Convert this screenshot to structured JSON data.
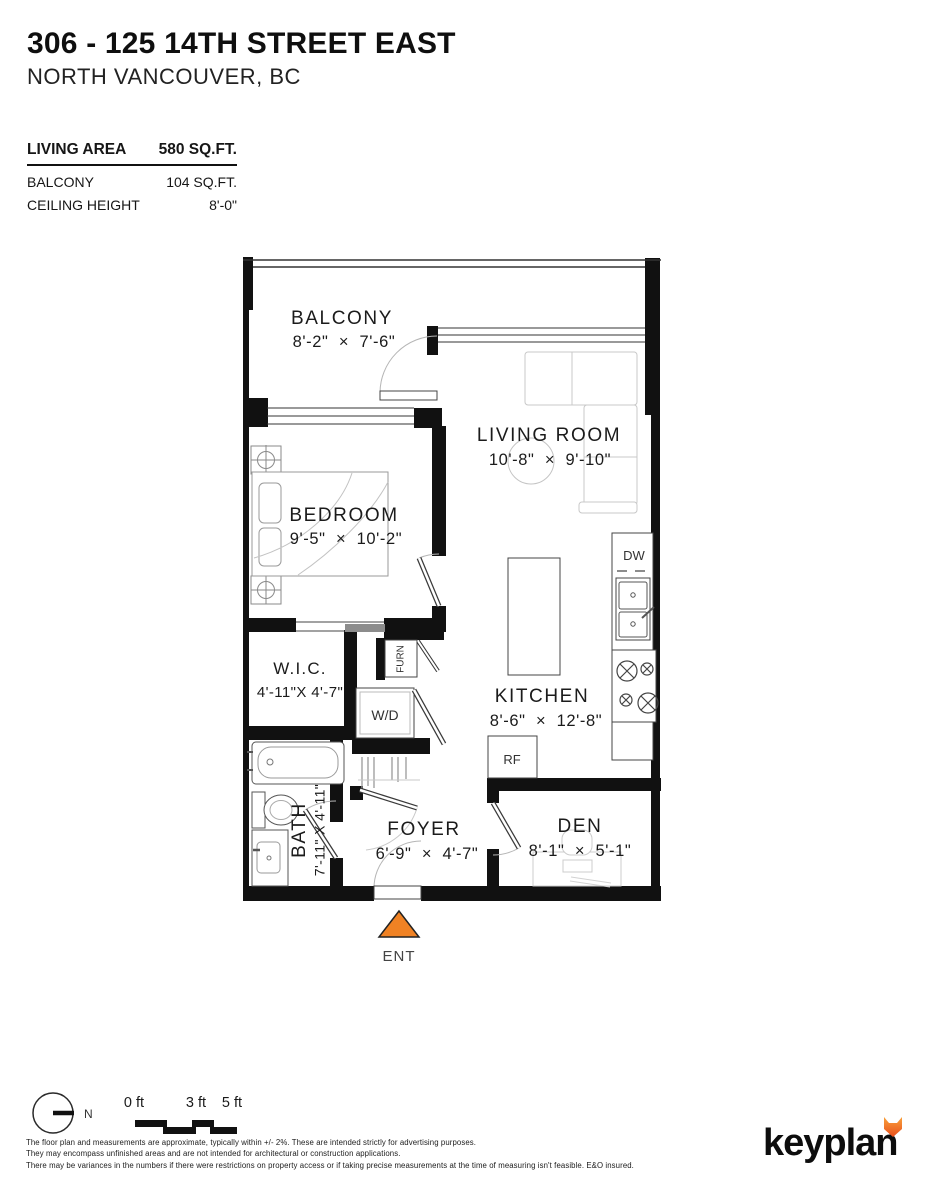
{
  "header": {
    "title": "306 - 125 14TH STREET EAST",
    "subtitle": "NORTH VANCOUVER, BC"
  },
  "stats": {
    "rows": [
      {
        "label": "LIVING AREA",
        "value": "580 SQ.FT."
      },
      {
        "label": "BALCONY",
        "value": "104 SQ.FT."
      },
      {
        "label": "CEILING HEIGHT",
        "value": "8'-0\""
      }
    ]
  },
  "rooms": {
    "balcony": {
      "name": "BALCONY",
      "dims": "8'-2\"  ×  7'-6\""
    },
    "living_room": {
      "name": "LIVING ROOM",
      "dims": "10'-8\"  ×  9'-10\""
    },
    "bedroom": {
      "name": "BEDROOM",
      "dims": "9'-5\"  ×  10'-2\""
    },
    "wic": {
      "name": "W.I.C.",
      "dims": "4'-11\"X 4'-7\""
    },
    "kitchen": {
      "name": "KITCHEN",
      "dims": "8'-6\"  ×  12'-8\""
    },
    "bath": {
      "name": "BATH",
      "dims": "7'-11\" X 4'-11\""
    },
    "foyer": {
      "name": "FOYER",
      "dims": "6'-9\"  ×  4'-7\""
    },
    "den": {
      "name": "DEN",
      "dims": "8'-1\"  ×  5'-1\""
    }
  },
  "fixtures": {
    "dishwasher": "DW",
    "fridge": "RF",
    "washer_dryer": "W/D",
    "furnace": "FURN"
  },
  "entrance": {
    "label": "ENT"
  },
  "compass": {
    "label": "N"
  },
  "scale_bar": {
    "ticks": [
      "0 ft",
      "3 ft",
      "5 ft"
    ]
  },
  "disclaimer": {
    "lines": [
      "The floor plan and measurements are approximate, typically within +/- 2%. These are intended strictly for advertising purposes.",
      "They may encompass unfinished areas and are not intended for architectural or construction applications.",
      "There may be variances in the numbers if there were restrictions on property access or if taking precise measurements at the time of measuring isn't feasible. E&O insured."
    ]
  },
  "brand": {
    "logo": "keyplan"
  },
  "colors": {
    "wall": "#111111",
    "accent": "#F08224",
    "fox_top": "#F9A23C",
    "fox_bottom": "#E94E1B"
  }
}
